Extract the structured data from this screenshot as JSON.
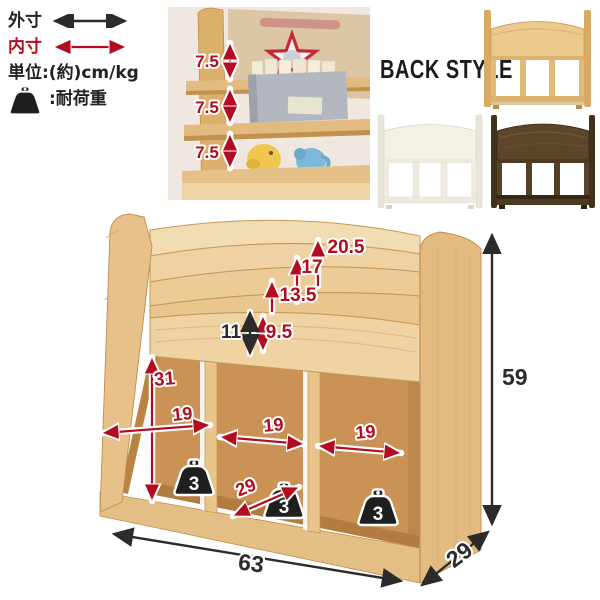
{
  "legend": {
    "outer_label": "外寸",
    "inner_label": "内寸",
    "unit_label": "単位:(約)cm/kg",
    "load_label": ":耐荷重"
  },
  "photo": {
    "tier_depths": [
      "7.5",
      "7.5",
      "7.5"
    ]
  },
  "back_style": {
    "title": "BACK STYLE",
    "variants": [
      {
        "name": "natural",
        "panel_color": "#ecca8e"
      },
      {
        "name": "white",
        "panel_color": "#f4f1e6"
      },
      {
        "name": "dark-brown",
        "panel_color": "#5c452a"
      }
    ]
  },
  "diagram": {
    "step_heights": [
      "20.5",
      "17",
      "13.5"
    ],
    "inner_pocket_height": "9.5",
    "rail_height": "11",
    "compartment_inner_height": "31",
    "compartment_widths": [
      "19",
      "19",
      "19"
    ],
    "compartment_depth": "29",
    "load_capacities": [
      "3",
      "3",
      "3"
    ],
    "overall_width": "63",
    "overall_depth": "29",
    "overall_height": "59"
  },
  "colors": {
    "dimension_inner_red": "#b30b20",
    "dimension_outer_black": "#2b2b2b",
    "wood_natural": "#eccf9e"
  }
}
